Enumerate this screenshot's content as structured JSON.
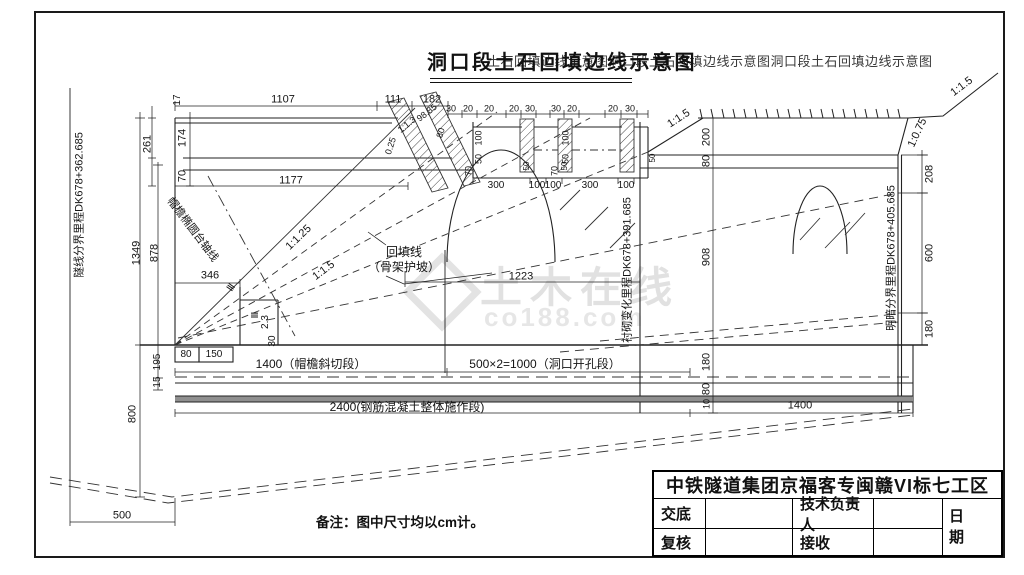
{
  "title": {
    "main": "洞口段土石回填边线示意图",
    "overlay": "土石回填边线示意图洞口段土石回填边线示意图洞口段土石回填边线示意图"
  },
  "note": "备注：图中尺寸均以cm计。",
  "watermark": {
    "brand": "土木在线",
    "site": "co188.com"
  },
  "title_block": {
    "company": "中铁隧道集团京福客专闽赣VI标七工区",
    "handover_label": "交底",
    "tech_lead_label": "技术负责人",
    "date_label": "日 期",
    "review_label": "复核",
    "receive_label": "接收"
  },
  "colors": {
    "line": "#222222",
    "slab_gray": "#8f8f8f",
    "watermark_gray": "#c9c9c9"
  },
  "annotations": [
    {
      "t": "17",
      "x": 178,
      "y": 100,
      "r": -90,
      "fs": 10
    },
    {
      "t": "1107",
      "x": 283,
      "y": 100
    },
    {
      "t": "111",
      "x": 393,
      "y": 100
    },
    {
      "t": "182",
      "x": 432,
      "y": 100
    },
    {
      "t": "30",
      "x": 451,
      "y": 109,
      "fs": 9
    },
    {
      "t": "20",
      "x": 468,
      "y": 109,
      "fs": 9
    },
    {
      "t": "20",
      "x": 489,
      "y": 109,
      "fs": 9
    },
    {
      "t": "20",
      "x": 514,
      "y": 109,
      "fs": 9
    },
    {
      "t": "30",
      "x": 530,
      "y": 109,
      "fs": 9
    },
    {
      "t": "30",
      "x": 556,
      "y": 109,
      "fs": 9
    },
    {
      "t": "20",
      "x": 572,
      "y": 109,
      "fs": 9
    },
    {
      "t": "20",
      "x": 613,
      "y": 109,
      "fs": 9
    },
    {
      "t": "30",
      "x": 630,
      "y": 109,
      "fs": 9
    },
    {
      "t": "261",
      "x": 148,
      "y": 144,
      "r": -90
    },
    {
      "t": "174",
      "x": 183,
      "y": 138,
      "r": -90
    },
    {
      "t": "70",
      "x": 183,
      "y": 176,
      "r": -90
    },
    {
      "t": "1177",
      "x": 291,
      "y": 181
    },
    {
      "t": "1349",
      "x": 137,
      "y": 253,
      "r": -90
    },
    {
      "t": "878",
      "x": 155,
      "y": 253,
      "r": -90
    },
    {
      "t": "346",
      "x": 210,
      "y": 276
    },
    {
      "t": "Ⅲ",
      "x": 232,
      "y": 288,
      "r": -55,
      "fs": 10
    },
    {
      "t": "Ⅲ",
      "x": 256,
      "y": 315,
      "r": -90,
      "fs": 10
    },
    {
      "t": "2.3",
      "x": 266,
      "y": 322,
      "r": -90,
      "fs": 10
    },
    {
      "t": "30",
      "x": 273,
      "y": 341,
      "r": -90,
      "fs": 10
    },
    {
      "t": "1:1.25",
      "x": 299,
      "y": 238,
      "r": -44
    },
    {
      "t": "1:1.5",
      "x": 324,
      "y": 271,
      "r": -37
    },
    {
      "t": "帽檐椭圆台轴线",
      "x": 192,
      "y": 230,
      "r": 53,
      "fs": 11,
      "n": "brim-axis-label"
    },
    {
      "t": "0.25",
      "x": 391,
      "y": 146,
      "r": -72,
      "fs": 9
    },
    {
      "t": "1:1.3",
      "x": 407,
      "y": 125,
      "r": -38,
      "fs": 9
    },
    {
      "t": "98.85",
      "x": 427,
      "y": 113,
      "r": -38,
      "fs": 9
    },
    {
      "t": "80",
      "x": 441,
      "y": 133,
      "r": -72,
      "fs": 9
    },
    {
      "t": "100",
      "x": 479,
      "y": 138,
      "r": -90,
      "fs": 9
    },
    {
      "t": "50",
      "x": 479,
      "y": 159,
      "r": -90,
      "fs": 9
    },
    {
      "t": "70",
      "x": 469,
      "y": 171,
      "r": -90,
      "fs": 9
    },
    {
      "t": "100",
      "x": 566,
      "y": 138,
      "r": -90,
      "fs": 9
    },
    {
      "t": "50",
      "x": 566,
      "y": 159,
      "r": -90,
      "fs": 9
    },
    {
      "t": "70",
      "x": 555,
      "y": 171,
      "r": -90,
      "fs": 9
    },
    {
      "t": "50",
      "x": 527,
      "y": 166,
      "r": -90,
      "fs": 8
    },
    {
      "t": "50",
      "x": 565,
      "y": 166,
      "r": -90,
      "fs": 8
    },
    {
      "t": "50",
      "x": 653,
      "y": 158,
      "r": -90,
      "fs": 8
    },
    {
      "t": "300",
      "x": 496,
      "y": 186,
      "fs": 10
    },
    {
      "t": "100",
      "x": 537,
      "y": 186,
      "fs": 10
    },
    {
      "t": "100",
      "x": 553,
      "y": 186,
      "fs": 10
    },
    {
      "t": "300",
      "x": 590,
      "y": 186,
      "fs": 10
    },
    {
      "t": "100",
      "x": 626,
      "y": 186,
      "fs": 10
    },
    {
      "t": "回填线",
      "x": 404,
      "y": 252,
      "fs": 12,
      "n": "backfill-line-label"
    },
    {
      "t": "（骨架护坡）",
      "x": 404,
      "y": 267,
      "fs": 12,
      "n": "backfill-line-sublabel"
    },
    {
      "t": "1223",
      "x": 521,
      "y": 277
    },
    {
      "t": "1:1.5",
      "x": 679,
      "y": 119,
      "r": -33
    },
    {
      "t": "200",
      "x": 707,
      "y": 137,
      "r": -90
    },
    {
      "t": "80",
      "x": 707,
      "y": 161,
      "r": -90
    },
    {
      "t": "908",
      "x": 707,
      "y": 257,
      "r": -90
    },
    {
      "t": "180",
      "x": 707,
      "y": 362,
      "r": -90
    },
    {
      "t": "80",
      "x": 707,
      "y": 389,
      "r": -90
    },
    {
      "t": "10",
      "x": 707,
      "y": 404,
      "r": -90,
      "fs": 9
    },
    {
      "t": "1:0.75",
      "x": 918,
      "y": 133,
      "r": -65
    },
    {
      "t": "1:1.5",
      "x": 962,
      "y": 87,
      "r": -37
    },
    {
      "t": "208",
      "x": 930,
      "y": 174,
      "r": -90
    },
    {
      "t": "600",
      "x": 930,
      "y": 253,
      "r": -90
    },
    {
      "t": "180",
      "x": 930,
      "y": 329,
      "r": -90
    },
    {
      "t": "80",
      "x": 186,
      "y": 355,
      "fs": 10
    },
    {
      "t": "150",
      "x": 214,
      "y": 355,
      "fs": 10
    },
    {
      "t": "195",
      "x": 158,
      "y": 362,
      "r": -90,
      "fs": 10
    },
    {
      "t": "15",
      "x": 158,
      "y": 382,
      "r": -90,
      "fs": 10
    },
    {
      "t": "800",
      "x": 133,
      "y": 414,
      "r": -90
    },
    {
      "t": "500",
      "x": 122,
      "y": 516
    },
    {
      "t": "1400（帽檐斜切段）",
      "x": 311,
      "y": 364,
      "fs": 12,
      "n": "section-label-1400"
    },
    {
      "t": "500×2=1000（洞口开孔段）",
      "x": 545,
      "y": 364,
      "fs": 12,
      "n": "section-label-1000"
    },
    {
      "t": "2400(钢筋混凝土整体施作段)",
      "x": 407,
      "y": 407,
      "fs": 12,
      "n": "section-label-2400"
    },
    {
      "t": "1400",
      "x": 800,
      "y": 406
    },
    {
      "t": "隧线分界里程DK678+362.685",
      "x": 80,
      "y": 205,
      "r": -90,
      "fs": 11,
      "n": "milestone-tunnel-boundary"
    },
    {
      "t": "衬砌变化里程DK678+391.685",
      "x": 628,
      "y": 270,
      "r": -90,
      "fs": 11,
      "n": "milestone-lining-change"
    },
    {
      "t": "明暗分界里程DK678+405.685",
      "x": 892,
      "y": 258,
      "r": -90,
      "fs": 11,
      "n": "milestone-portal-boundary"
    }
  ]
}
